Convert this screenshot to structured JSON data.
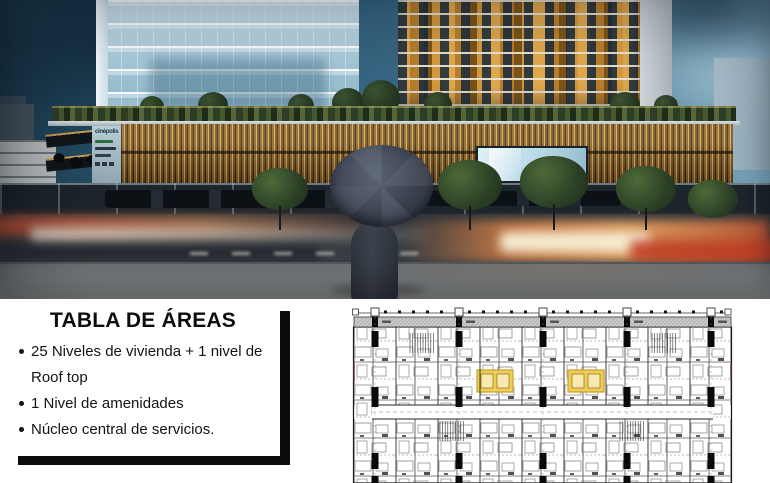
{
  "hero": {
    "description": "Render crepuscular de conjunto de uso mixto: torre de oficinas de cristal, torre de vivienda con celosías naranjas, podio con lamas de madera, persona con paraguas frente a tráfico con desenfoque de movimiento",
    "signage_brand": "cinépolis",
    "colors": {
      "sky_dark": "#1d3c50",
      "sky_light": "#7fa8bd",
      "office_glass": "#b3d0de",
      "residential_panels": "#d49a3f",
      "wood_lattice": "#b98a3c",
      "traffic_red": "#be462d",
      "traffic_orange": "#dc8246",
      "umbrella": "#424957"
    }
  },
  "areas_card": {
    "title": "TABLA DE ÁREAS",
    "bullets": [
      "25 Niveles de vivienda + 1 nivel de Roof top",
      "1 Nivel de amenidades",
      "Núcleo central de servicios."
    ]
  },
  "floor_plan": {
    "description": "Planta arquitectónica tipo con dos núcleos de elevadores resaltados en amarillo",
    "highlight_color": "#EFCE58",
    "highlight_border": "#C9A227"
  }
}
